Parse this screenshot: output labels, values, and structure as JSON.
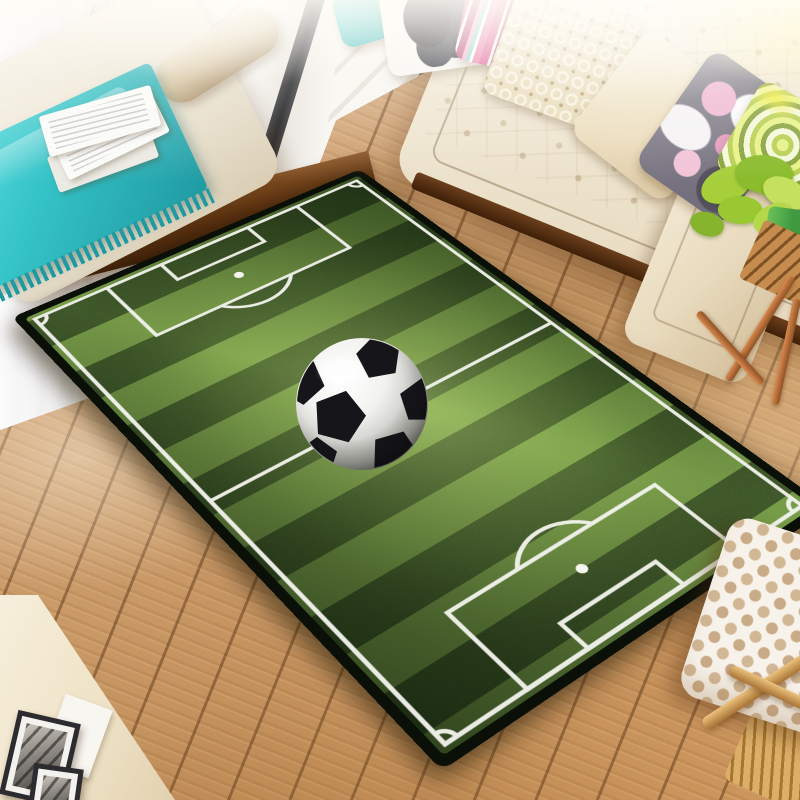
{
  "meta": {
    "domain": "Natural-Image",
    "description": "Lifestyle product photograph of a rectangular soccer-field print area rug with a 3D soccer ball graphic, laid diagonally on a light oak plank floor in a bright living room. A cream tufted sofa with colorful pillows sits at the top, a white chaise bench with a teal fringed throw and magazines at the upper left, a black-framed window with sheer curtain behind, a green plant on a copper-legged side table at the right, framed pictures lean in the lower-left corner, and a white quilted pouf on a wooden stool sits at the lower right.",
    "visible_text": ""
  },
  "colors": {
    "floor_light": "#dcb488",
    "floor_mid": "#c89a66",
    "floor_seam": "#7d5027",
    "balcony_plank": "#f8f6f2",
    "frame_black": "#1d1d20",
    "curtain": "#f4f3f4",
    "bench_cream": "#f2ecdf",
    "bolster_tan": "#d9c6a2",
    "teal": "#35c4c8",
    "teal_dark": "#1f9aa2",
    "magazine_white": "#fbfbf9",
    "platform_wood": "#5e3512",
    "sofa_cream": "#f3ebd9",
    "sofa_rail": "#4a2a10",
    "pink_stripe": "#d94a86",
    "pink_light": "#f2a8c6",
    "stripe_teal": "#7fd2cc",
    "lattice_base": "#e9dbb9",
    "floral_gray": "#837f8c",
    "floral_pink": "#eeaccb",
    "swirl_green": "#b8cf52",
    "plant_green": "#93c832",
    "pot_green": "#4aac4a",
    "copper": "#c57a40",
    "rug_border": "#0a0f08",
    "grass_light": "#6f9440",
    "grass_dark": "#2c421b",
    "line_white": "#f4f5ef",
    "ball_black": "#15151a",
    "pouf_base": "#f7f2ea",
    "pouf_tan": "#d2b795",
    "stool_wood": "#d8a45e",
    "wall_cream": "#f1e6cc",
    "photo_gray": "#8d8a84"
  },
  "scene": {
    "room": {
      "floor": "light oak diagonal planks",
      "lighting": "bright daylight wash from top"
    },
    "objects": [
      {
        "id": "balcony-window",
        "label": "black-framed window, white deck planks, sheer curtain"
      },
      {
        "id": "chaise",
        "label": "cream chaise bench with tan bolster cushion on dark wood platform"
      },
      {
        "id": "teal-throw",
        "label": "teal fringed throw blanket"
      },
      {
        "id": "magazines",
        "label": "stack of magazines"
      },
      {
        "id": "sofa",
        "label": "cream tufted sofa with dark wood base rail"
      },
      {
        "id": "pillows",
        "label": "teal, butterfly print, pink striped, beige lattice, plain cream, grey-pink floral, green swirl"
      },
      {
        "id": "plant",
        "label": "green houseplant in green pot on slatted side table with copper legs"
      },
      {
        "id": "rug",
        "label": "soccer field area rug with 3D soccer ball at center"
      },
      {
        "id": "frames",
        "label": "dark picture frames leaning in lower-left corner"
      },
      {
        "id": "pouf",
        "label": "white quilted lattice pouf on light wood stool"
      }
    ]
  },
  "rug": {
    "theme": "soccer field",
    "stripe_count": 14,
    "markings": [
      "outer boundary",
      "halfway line",
      "left penalty area",
      "left goal area",
      "left penalty spot",
      "left penalty arc",
      "right penalty area",
      "right goal area",
      "right penalty spot",
      "right penalty arc",
      "corner arcs"
    ],
    "center_graphic": "3D soccer ball",
    "center_circle": "none"
  },
  "ball": {
    "size": 134,
    "patches": [
      {
        "cx": 44,
        "cy": 80,
        "r": 27,
        "rot": 15
      },
      {
        "cx": 84,
        "cy": 20,
        "r": 23,
        "rot": -10
      },
      {
        "cx": 6,
        "cy": 44,
        "r": 24,
        "rot": 30
      },
      {
        "cx": 127,
        "cy": 64,
        "r": 23,
        "rot": 0
      },
      {
        "cx": 100,
        "cy": 118,
        "r": 25,
        "rot": 20
      },
      {
        "cx": 22,
        "cy": 121,
        "r": 21,
        "rot": 0
      }
    ]
  }
}
